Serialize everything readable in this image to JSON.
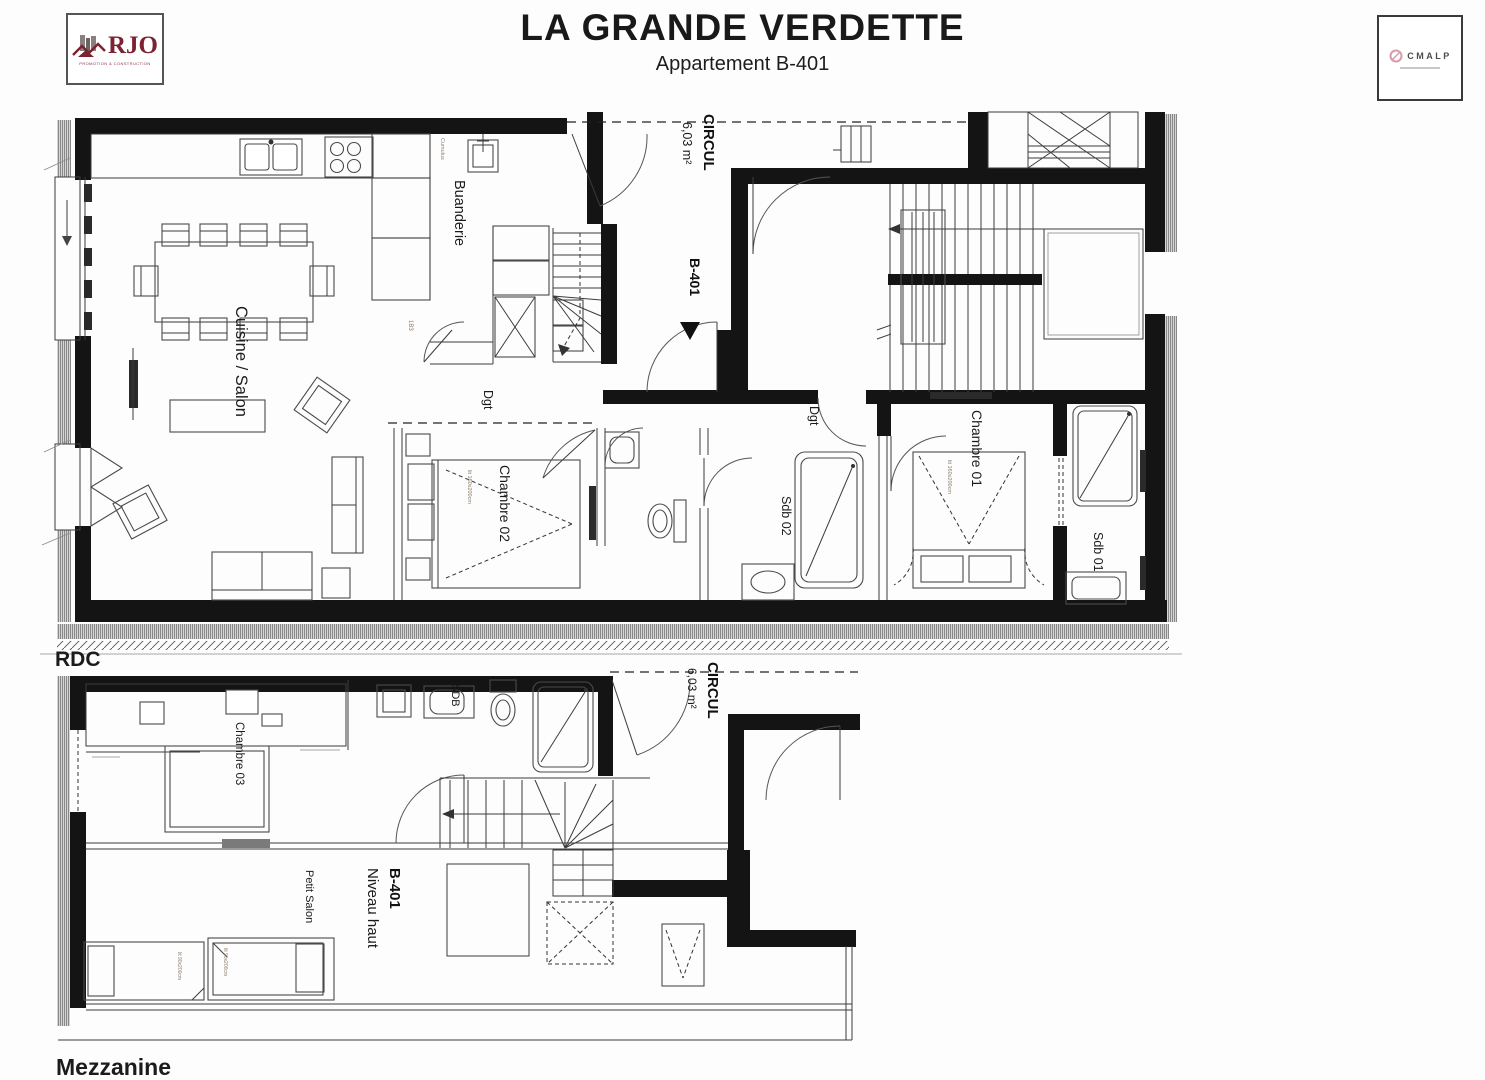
{
  "header": {
    "title": "LA GRANDE VERDETTE",
    "subtitle": "Appartement B-401",
    "logo_rjo": {
      "name": "RJO",
      "tagline": "PROMOTION & CONSTRUCTION",
      "color": "#7d2230"
    },
    "logo_cmalp": {
      "name": "CMALP",
      "accent": "#d99aab"
    }
  },
  "rdc": {
    "caption": "RDC",
    "rooms": {
      "cuisine": "Cuisine / Salon",
      "buanderie": "Buanderie",
      "circul": "CIRCUL",
      "circul_area": "6,03 m²",
      "unit": "B-401",
      "dgt1": "Dgt",
      "dgt2": "Dgt",
      "chambre02": "Chambre 02",
      "sdb02": "Sdb 02",
      "chambre01": "Chambre 01",
      "sdb01": "Sdb 01"
    },
    "tags": {
      "door_code": "1B3",
      "water_heater": "Cumulus",
      "bed_double": "lit 160x200cm"
    }
  },
  "mezzanine": {
    "caption": "Mezzanine",
    "rooms": {
      "chambre03": "Chambre 03",
      "sdb": "SDB",
      "circul": "CIRCUL",
      "circul_area": "6,03 m²",
      "unit": "B-401",
      "niveau": "Niveau haut",
      "petit_salon": "Petit Salon"
    },
    "tags": {
      "bed_single": "lit 90x200cm"
    }
  }
}
